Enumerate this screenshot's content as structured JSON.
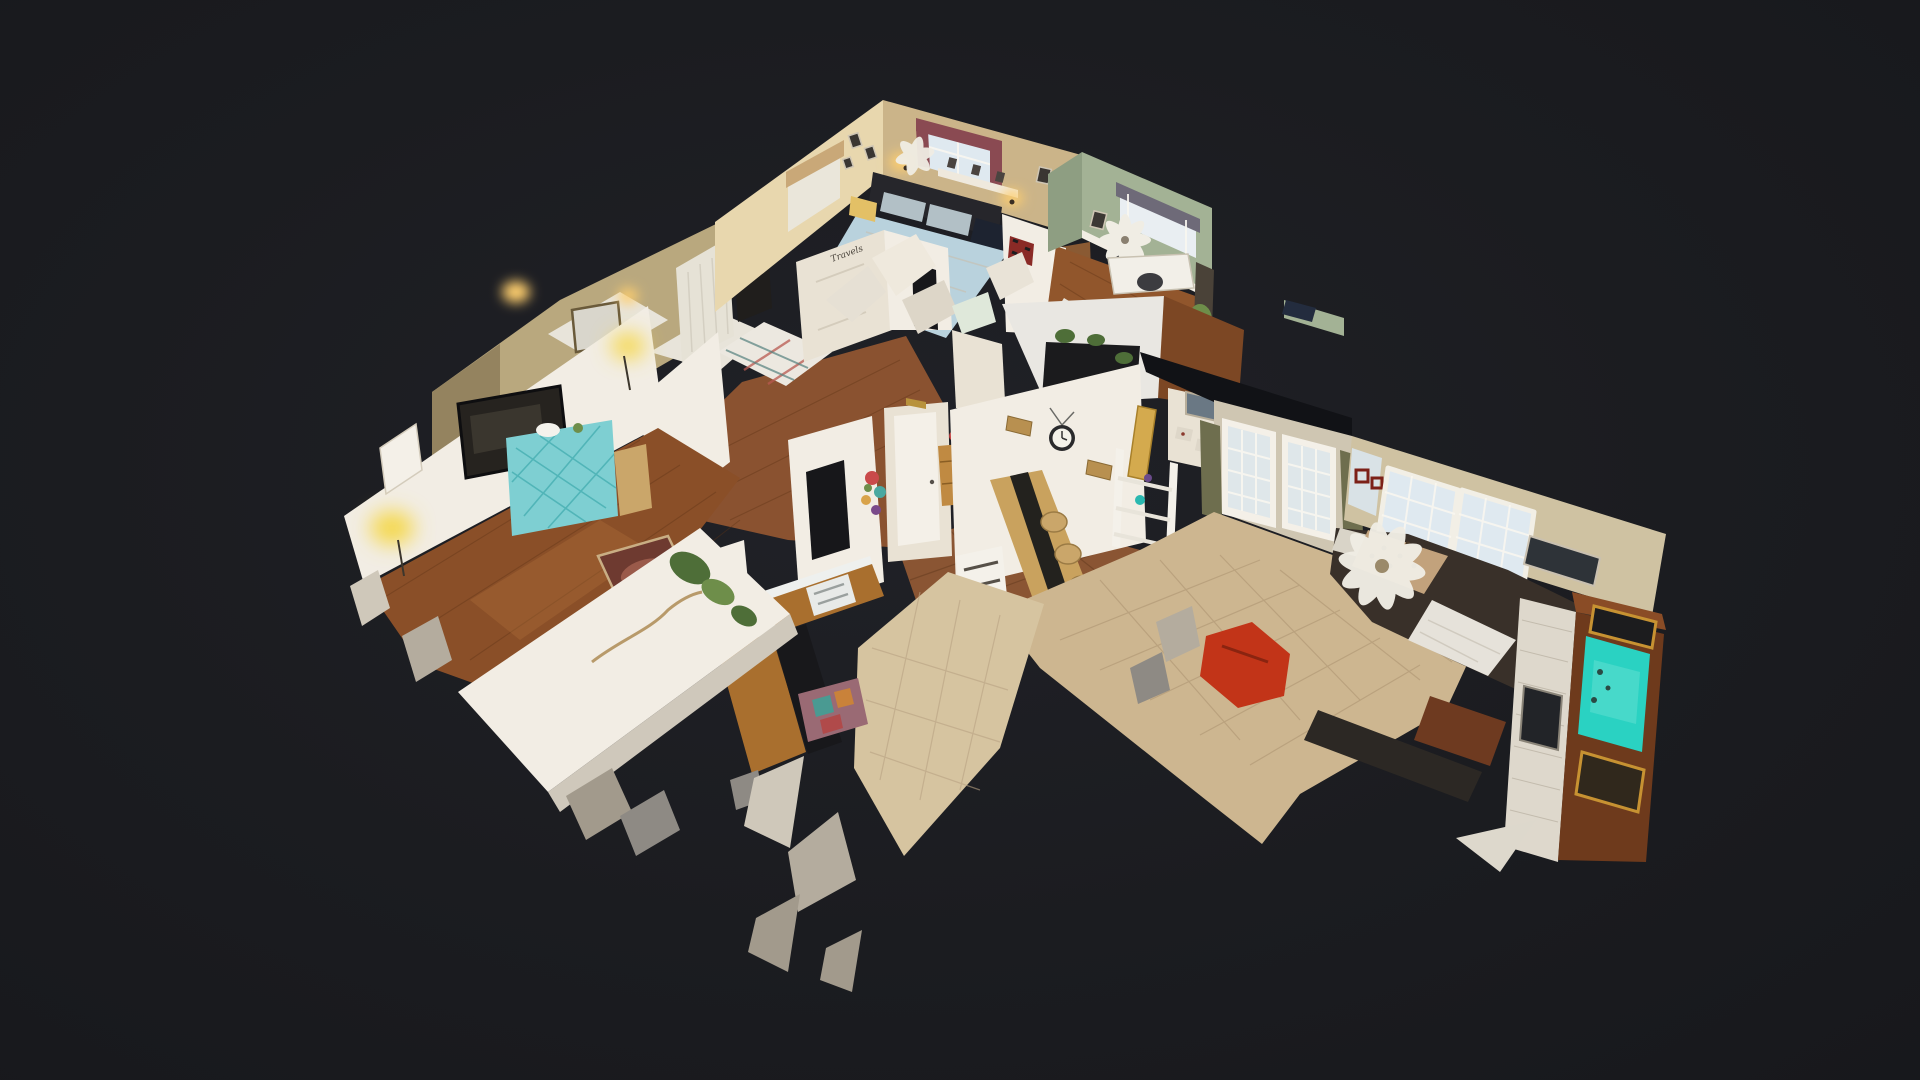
{
  "meta": {
    "app": "3D tour viewer",
    "view_mode": "dollhouse",
    "description": "Top-down angled dollhouse cutaway of a single-story ranch home rendered as a photogrammetry mesh with torn edges, floating on a dark canvas. No toolbar or UI chrome visible."
  },
  "canvas": {
    "width": 1920,
    "height": 1080,
    "background": "#1b1c20"
  },
  "decals": {
    "door_sign": "Travels"
  },
  "rooms": [
    {
      "id": "living-room",
      "name": "Living Room"
    },
    {
      "id": "hall-closet",
      "name": "Hall / Closet"
    },
    {
      "id": "bedroom-1",
      "name": "Bedroom"
    },
    {
      "id": "bedroom-2",
      "name": "Bedroom 2"
    },
    {
      "id": "office",
      "name": "Office / Study"
    },
    {
      "id": "hallway",
      "name": "Hallway"
    },
    {
      "id": "foyer",
      "name": "Foyer"
    },
    {
      "id": "dining-area",
      "name": "Dining Area"
    },
    {
      "id": "kitchen",
      "name": "Kitchen"
    },
    {
      "id": "great-room",
      "name": "Great Room"
    }
  ],
  "palette": {
    "bg": "#1b1c20",
    "wall_white": "#f2ede4",
    "wall_cream": "#e9e2d4",
    "wall_dim": "#b9a87e",
    "wall_dim_dark": "#94835f",
    "wall_tan": "#cbb489",
    "wall_tan_lit": "#e8d7ae",
    "wall_green": "#a3b295",
    "wall_green_dark": "#8e9e82",
    "wood_living": "#8a4f28",
    "wood_living_sheen": "#b06f3a",
    "wood_hall": "#8a5230",
    "wood_office": "#91562c",
    "wood_strip": "#7c4724",
    "wood_bedroom": "#8a5a33",
    "tile_foyer": "#8a5533",
    "tile_beige": "#cdb690",
    "tile_kitchen": "#d6c4a0",
    "bed_blue": "#b9d2dd",
    "bed_white": "#e8e4da",
    "headboard_dark": "#26262b",
    "pillow_gray": "#b2c0c6",
    "pillow_navy": "#1d2330",
    "nightstand_yellow": "#e3c066",
    "curtain_maroon": "#8a4a52",
    "curtain_tan": "#c9a878",
    "curtain_gray": "#6e6a78",
    "curtain_olive": "#6e6e4e",
    "window_sky": "#dfe9f0",
    "glass_blue": "#dfe7ea",
    "tv_dark": "#26231f",
    "tv_reflect": "#3a362e",
    "console_teal": "#7ecfd2",
    "lamp_glow": "#f5d84e",
    "sconce_glow": "#ffcf6e",
    "rug_red": "#6e3a30",
    "rug_inner": "#9a5a4a",
    "rug_border": "#c9ae84",
    "rug_multi": "#9a6a74",
    "cabinet_wood": "#a96f2e",
    "cabinet_foyer": "#c08a42",
    "counter_white": "#eef0ee",
    "counter_black": "#1b1b1d",
    "plant_green": "#4e6e38",
    "plant_light": "#6e8e4a",
    "table_wood": "#c9a25e",
    "runner_dark": "#23221e",
    "chair_wicker": "#caa66a",
    "rack_white": "#f4f1ea",
    "ladder_yellow": "#d4aa4e",
    "sofa_dark": "#393029",
    "leopard": "#c2a27c",
    "blanket_white": "#e6e2da",
    "fan_white": "#f0ede4",
    "brick_white": "#ded8cc",
    "armoire_brown": "#6e3a1c",
    "armoire_top": "#8a4c26",
    "tv_screen_teal": "#2ad2c2",
    "tv_screen_light": "#7fe8da",
    "frame_gold": "#c79232",
    "frame_dark": "#2e3338",
    "pic_blue": "#6a7884",
    "panel_beige": "#ded7c9",
    "chair_red": "#c23418",
    "bench_dark": "#2c2824",
    "recliner_brown": "#6e3a20",
    "shard_light": "#cfc8ba",
    "shard_mid": "#b4ac9e",
    "shard_dark": "#a29a8c",
    "shard_silver": "#8e8a84",
    "door_white": "#f4f0e8",
    "doorway_dark": "#17171a",
    "quilt_red": "#8a2a26",
    "mail_gold": "#b8923c",
    "clock_rim": "#2a2a2c",
    "clock_face": "#f4f2ea",
    "ceiling_shadow": "#111216"
  }
}
